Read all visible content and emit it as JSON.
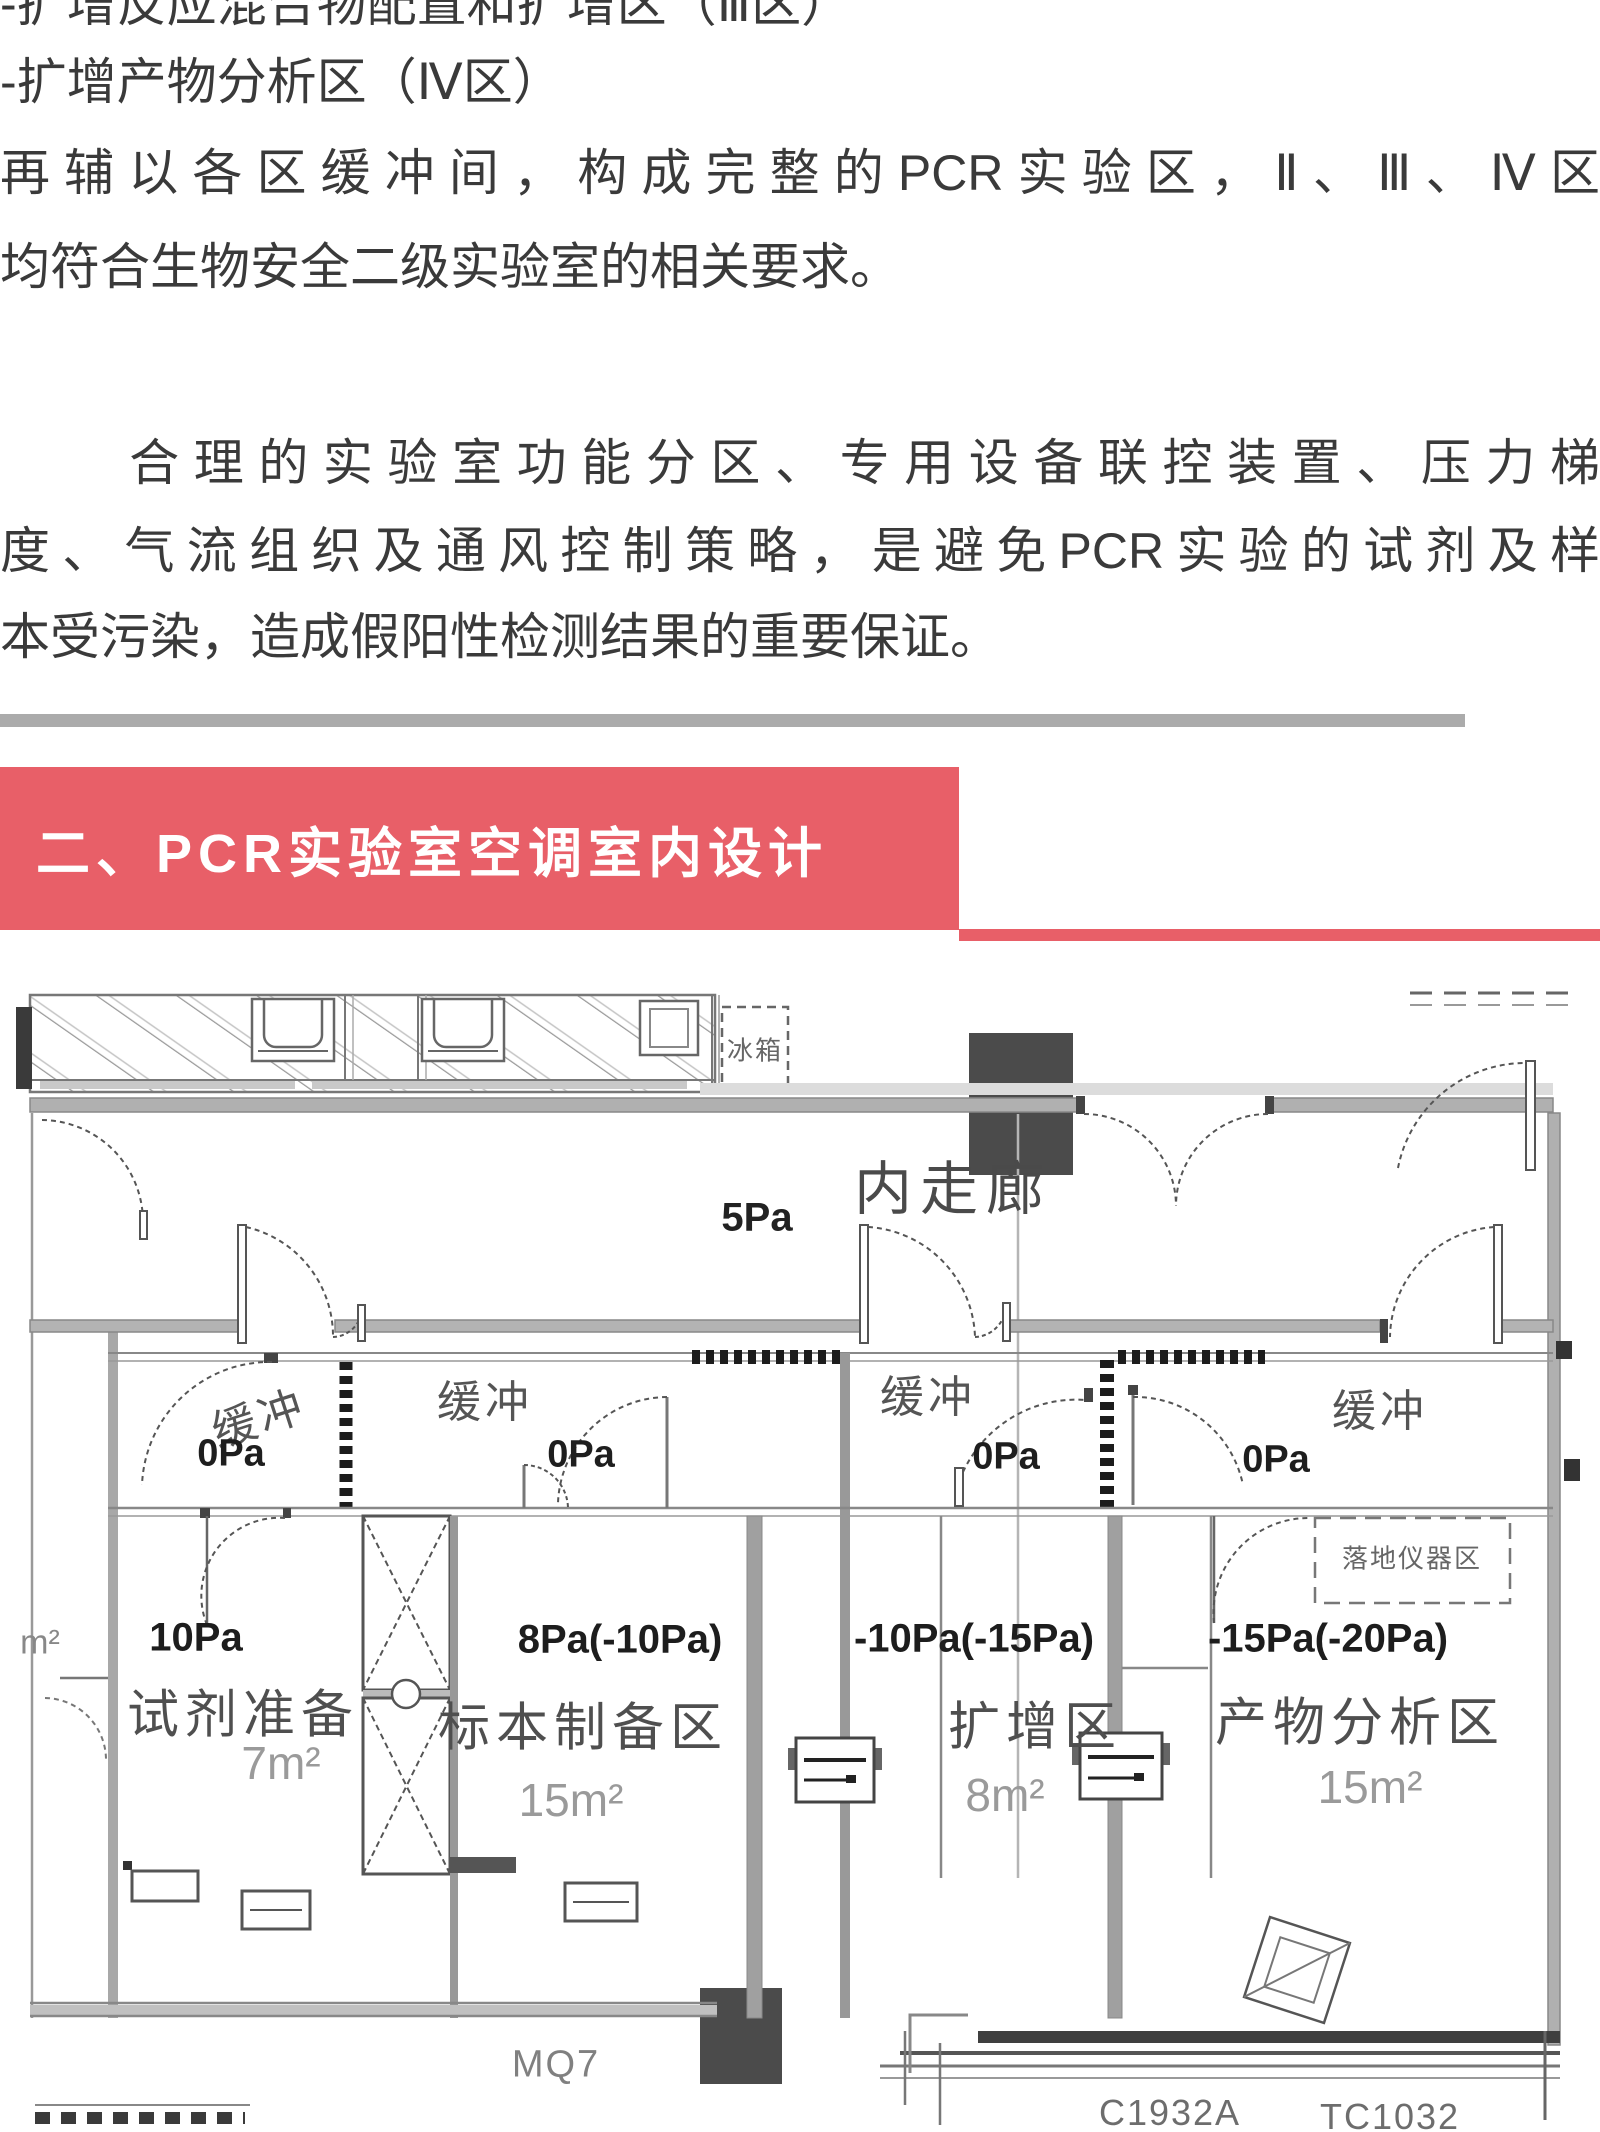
{
  "article": {
    "line_clipped": "-扩增反应混合物配置和扩增区（Ⅲ区）",
    "line_iv": "-扩增产物分析区（Ⅳ区）",
    "p1_l1": "再辅以各区缓冲间，构成完整的PCR实验区，Ⅱ、Ⅲ、Ⅳ区",
    "p1_l2": "均符合生物安全二级实验室的相关要求。",
    "p2_l1": "　　合理的实验室功能分区、专用设备联控装置、压力梯",
    "p2_l2": "度、气流组织及通风控制策略，是避免PCR实验的试剂及样",
    "p2_l3": "本受污染，造成假阳性检测结果的重要保证。"
  },
  "banner": {
    "title": "二、PCR实验室空调室内设计"
  },
  "colors": {
    "accent_red": "#E85F68",
    "divider_gray": "#ABABAB"
  },
  "floor_plan": {
    "corridor": {
      "name": "内走廊",
      "pressure": "5Pa"
    },
    "fridge_label": "冰箱",
    "buffer_rooms": [
      {
        "name": "缓冲",
        "pressure": "0Pa"
      },
      {
        "name": "缓冲",
        "pressure": "0Pa"
      },
      {
        "name": "缓冲",
        "pressure": "0Pa"
      },
      {
        "name": "缓冲",
        "pressure": "0Pa"
      }
    ],
    "labs": {
      "reagent": {
        "pressure": "10Pa",
        "name": "试剂准备",
        "area": "7m²"
      },
      "specimen": {
        "pressure": "8Pa(-10Pa)",
        "name": "标本制备区",
        "area": "15m²"
      },
      "amplification": {
        "pressure": "-10Pa(-15Pa)",
        "name": "扩增区",
        "area": "8m²"
      },
      "analysis": {
        "pressure": "-15Pa(-20Pa)",
        "name": "产物分析区",
        "area": "15m²"
      }
    },
    "instrument_zone": "落地仪器区",
    "partial_area_label": "m²",
    "drawing_codes": {
      "mq7": "MQ7",
      "code_left": "C1932A",
      "code_right": "TC1032"
    }
  }
}
